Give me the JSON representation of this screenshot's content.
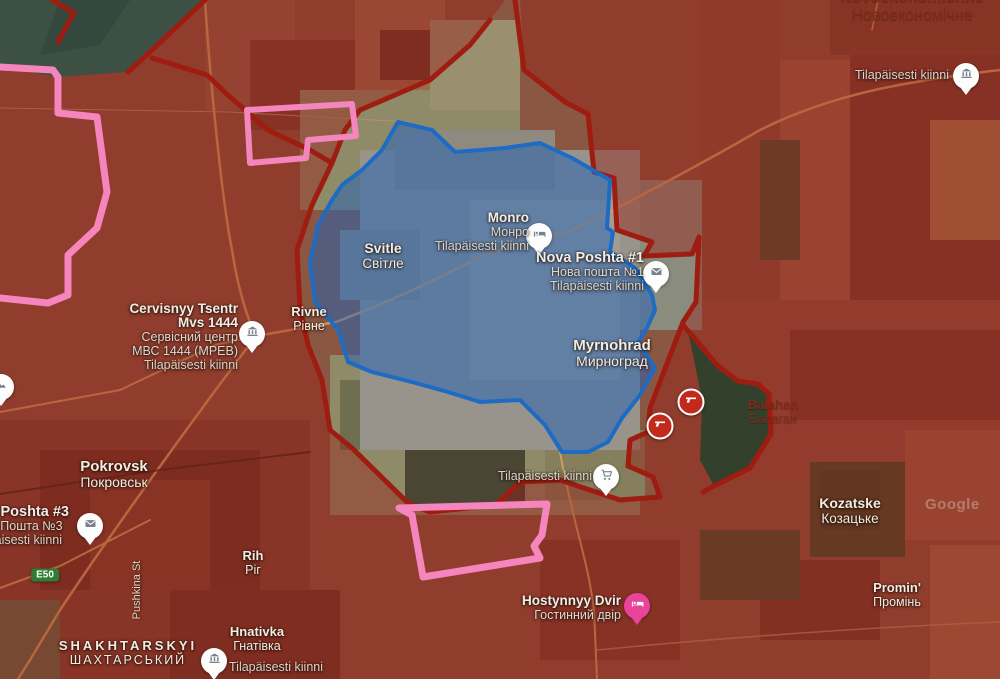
{
  "map": {
    "attribution": "Google"
  },
  "zones": {
    "occupied": {
      "fill": "rgba(152,26,16,0.42)",
      "border": "#9e1c10"
    },
    "contested": {
      "fill": "rgba(33,98,181,0.50)",
      "border": "#1e6bc4"
    },
    "claimed": {
      "border": "#f585bd"
    }
  },
  "road_badge": {
    "e50": "E50"
  },
  "street": {
    "pushkina": "Pushkina St"
  },
  "places": {
    "novoekonomichne": {
      "latin": "Novoekonomichne",
      "uk": "Новоекономічне"
    },
    "svitle": {
      "latin": "Svitle",
      "uk": "Світле"
    },
    "myrnohrad": {
      "latin": "Myrnohrad",
      "uk": "Мирноград"
    },
    "rivne": {
      "latin": "Rivne",
      "uk": "Рівне"
    },
    "pokrovsk": {
      "latin": "Pokrovsk",
      "uk": "Покровськ"
    },
    "balahan": {
      "latin": "Balahan",
      "uk": "Балаган"
    },
    "kozatske": {
      "latin": "Kozatske",
      "uk": "Козацьке"
    },
    "promin": {
      "latin": "Promin'",
      "uk": "Промінь"
    },
    "rih": {
      "latin": "Rih",
      "uk": "Ріг"
    },
    "shakhtarskyi": {
      "latin": "SHAKHTARSKYI",
      "uk": "ШАХТАРСЬКИЙ"
    },
    "hnativka": {
      "latin": "Hnativka",
      "uk": "Гнатівка"
    }
  },
  "pois": {
    "novoekonomichne_poi": {
      "status": "Tilapäisesti kiinni"
    },
    "monro": {
      "name": "Monro",
      "name_uk": "Монро",
      "status": "Tilapäisesti kiinni"
    },
    "nova_poshta_1": {
      "name": "Nova Poshta #1",
      "name_uk": "Нова пошта №1",
      "status": "Tilapäisesti kiinni"
    },
    "cervisnyy": {
      "name_line1": "Cervisnyy Tsentr",
      "name_line2": "Mvs 1444",
      "name_uk_line1": "Сервісний центр",
      "name_uk_line2": "МВС 1444 (МРЕВ)",
      "status": "Tilapäisesti kiinni"
    },
    "nova_poshta_3": {
      "name": "Nova Poshta #3",
      "name_uk": "Нова Пошта №3",
      "status": "Tilapäisesti kiinni"
    },
    "store": {
      "status": "Tilapäisesti kiinni"
    },
    "hostynnyy": {
      "name": "Hostynnyy Dvir",
      "name_uk": "Гостинний двір"
    },
    "hnativka_poi": {
      "status": "Tilapäisesti kiinni"
    }
  }
}
